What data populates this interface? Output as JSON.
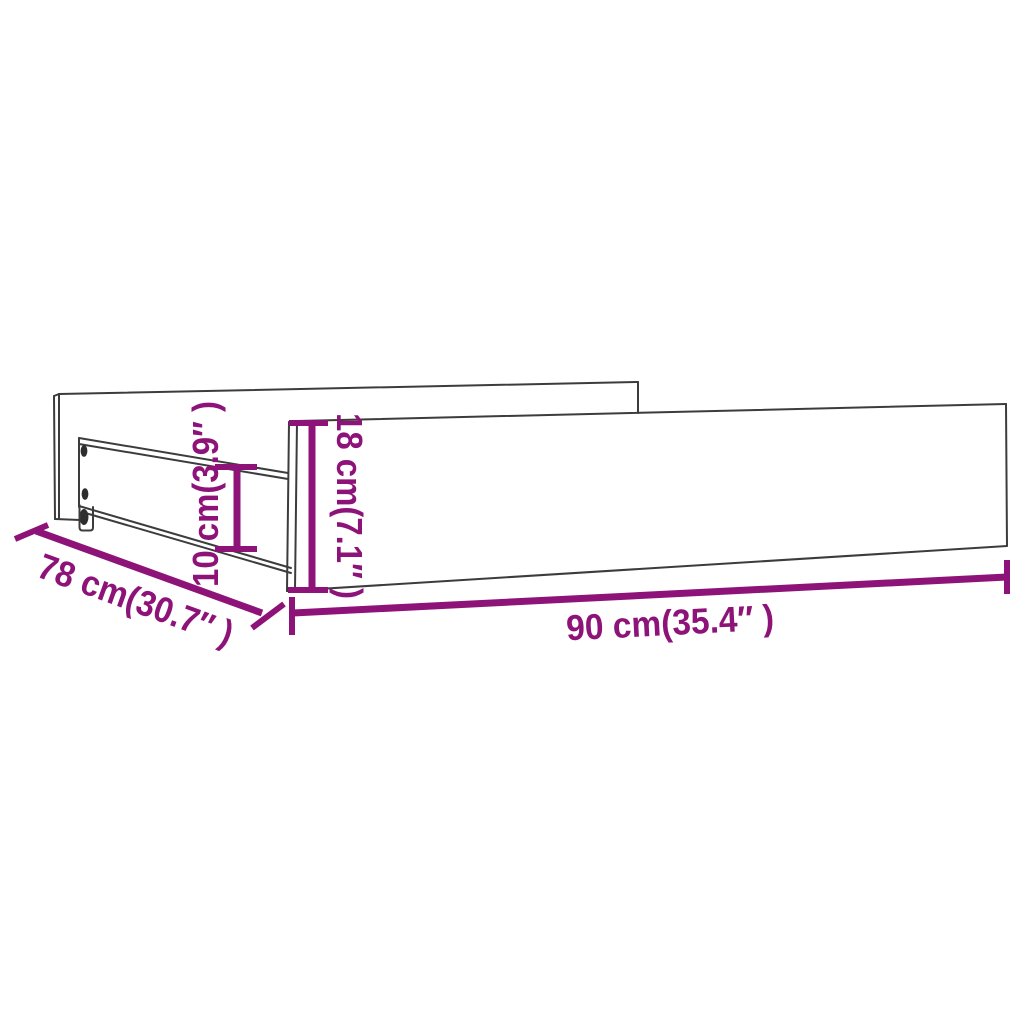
{
  "diagram": {
    "kind": "furniture-dimension-line-drawing",
    "subject": "under-bed drawer with casters",
    "colors": {
      "background": "#ffffff",
      "outline": "#3c3c3c",
      "dimension_accent": "#8e1379",
      "hardware_dark": "#2e2e2e"
    },
    "dimensions": {
      "length": "90 cm(35.4″ )",
      "depth": "78 cm(30.7″ )",
      "front_height": "18 cm(7.1″ )",
      "side_height": "10 cm(3.9″ )"
    }
  }
}
